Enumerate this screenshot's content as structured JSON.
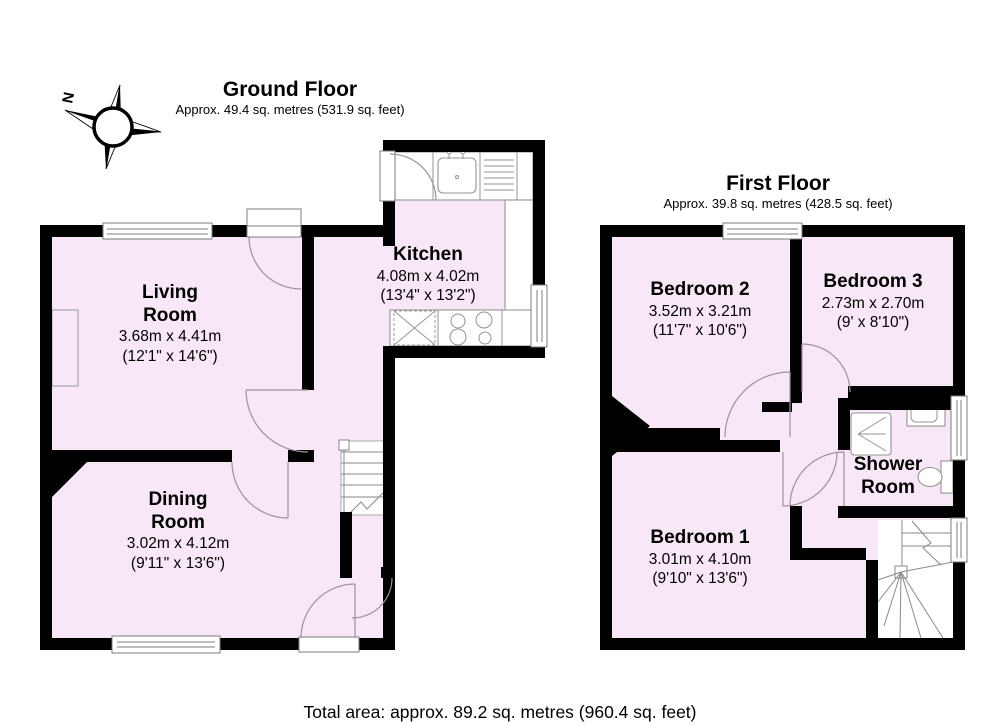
{
  "titles": {
    "ground": {
      "title": "Ground Floor",
      "subtitle": "Approx. 49.4 sq. metres (531.9 sq. feet)"
    },
    "first": {
      "title": "First Floor",
      "subtitle": "Approx. 39.8 sq. metres (428.5 sq. feet)"
    }
  },
  "compass": {
    "north_label": "N"
  },
  "rooms": {
    "living": {
      "name1": "Living",
      "name2": "Room",
      "metric": "3.68m x 4.41m",
      "imperial": "(12'1\" x 14'6\")"
    },
    "kitchen": {
      "name1": "Kitchen",
      "metric": "4.08m x 4.02m",
      "imperial": "(13'4\" x 13'2\")"
    },
    "dining": {
      "name1": "Dining",
      "name2": "Room",
      "metric": "3.02m x 4.12m",
      "imperial": "(9'11\" x 13'6\")"
    },
    "bedroom2": {
      "name1": "Bedroom 2",
      "metric": "3.52m x 3.21m",
      "imperial": "(11'7\" x 10'6\")"
    },
    "bedroom3": {
      "name1": "Bedroom 3",
      "metric": "2.73m x 2.70m",
      "imperial": "(9' x 8'10\")"
    },
    "bedroom1": {
      "name1": "Bedroom 1",
      "metric": "3.01m x 4.10m",
      "imperial": "(9'10\" x 13'6\")"
    },
    "shower": {
      "name1": "Shower",
      "name2": "Room"
    }
  },
  "footer": {
    "total_area": "Total area: approx. 89.2 sq. metres (960.4 sq. feet)"
  },
  "colors": {
    "room_fill": "#f8e7f6",
    "wall": "#000000",
    "fixture_line": "#949494"
  }
}
